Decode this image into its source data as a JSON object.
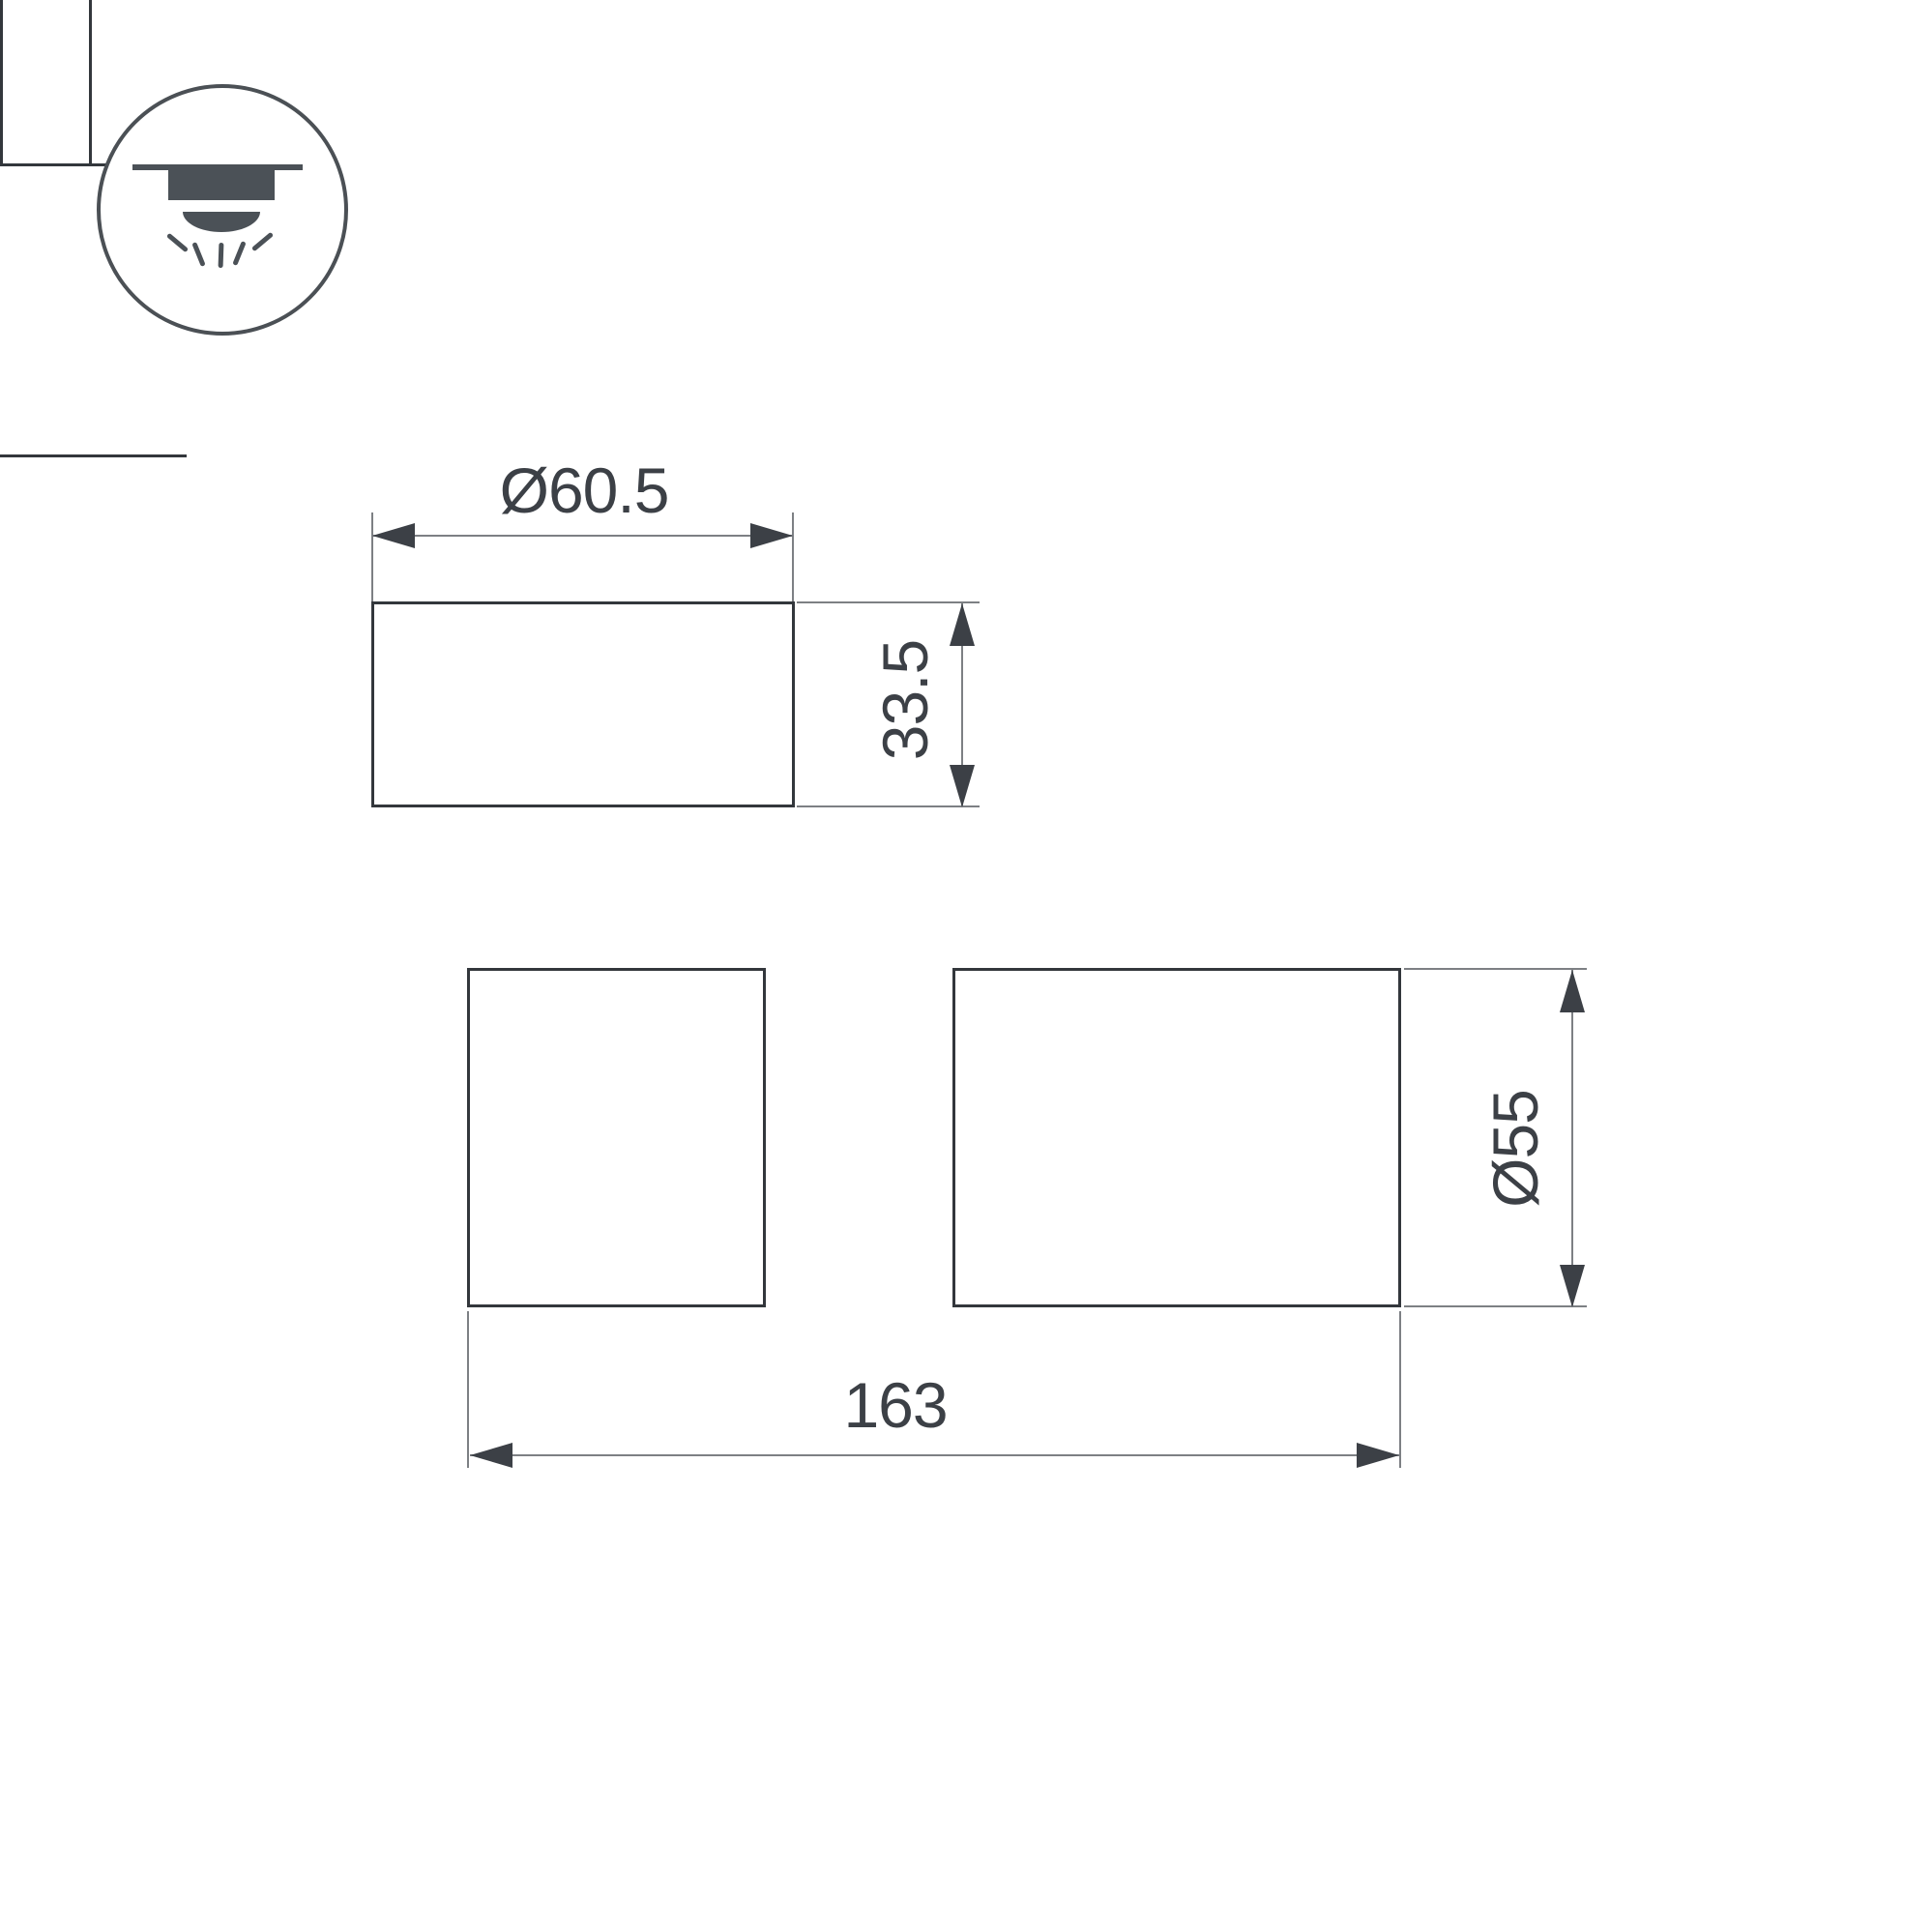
{
  "page": {
    "background": "#ffffff",
    "type": "technical-dimension-drawing"
  },
  "icon": {
    "name": "surface-mounted-ceiling-light",
    "color": "#4b5157",
    "circle_stroke": "#4b5055"
  },
  "dimensions": {
    "top_diameter": "Ø60.5",
    "cap_height": "33.5",
    "body_diameter": "Ø55",
    "total_length": "163"
  },
  "colors": {
    "shape_stroke": "#33373c",
    "dimension_line": "#7d8084",
    "dimension_text": "#3c4046"
  }
}
